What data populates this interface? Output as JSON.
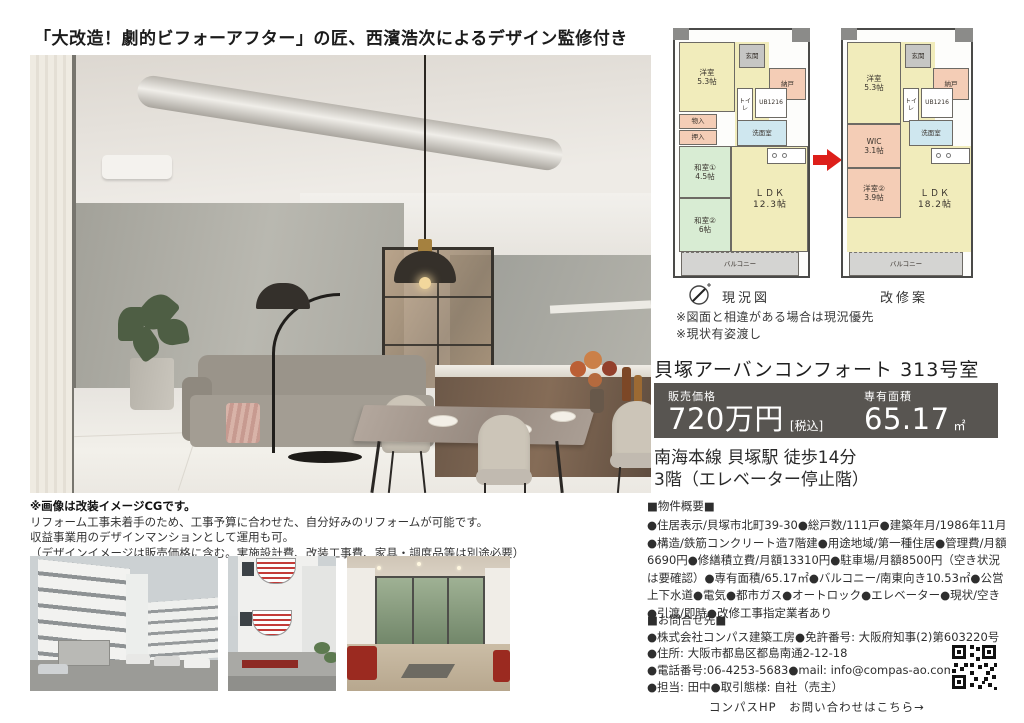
{
  "header": {
    "title": "「大改造！劇的ビフォーアフター」の匠、西濱浩次によるデザイン監修付き"
  },
  "floorplans": {
    "current": {
      "caption": "現況図",
      "rooms": {
        "yoshitsu": "洋室\n5.3帖",
        "genkan": "玄関",
        "nando": "納戸",
        "monoire": "物入",
        "oshiire": "押入",
        "washitsu1": "和室①\n4.5帖",
        "toilet": "トイレ",
        "ub": "UB1216",
        "senmen": "洗面室",
        "washitsu2": "和室②\n6帖",
        "ldk": "ＬＤＫ\n12.3帖",
        "balcony": "バルコニー"
      }
    },
    "renovated": {
      "caption": "改修案",
      "rooms": {
        "yoshitsu": "洋室\n5.3帖",
        "genkan": "玄関",
        "nando": "納戸",
        "wic": "WIC\n3.1帖",
        "toilet": "トイレ",
        "ub": "UB1216",
        "senmen": "洗面室",
        "yoshitsu2": "洋室②\n3.9帖",
        "ldk": "ＬＤＫ\n18.2帖",
        "balcony": "バルコニー"
      }
    },
    "notes": [
      "※図面と相違がある場合は現況優先",
      "※現状有姿渡し"
    ]
  },
  "property": {
    "name": "貝塚アーバンコンフォート 313号室",
    "price_label": "販売価格",
    "price": "720万円",
    "tax_note": "[税込]",
    "area_label": "専有面積",
    "area": "65.17",
    "area_unit": "㎡",
    "access": "南海本線 貝塚駅 徒歩14分",
    "floor": "3階（エレベーター停止階）"
  },
  "cg_note": {
    "title": "※画像は改装イメージCGです。",
    "lines": [
      "リフォーム工事未着手のため、工事予算に合わせた、自分好みのリフォームが可能です。",
      "収益事業用のデザインマンションとして運用も可。",
      "（デザインイメージは販売価格に含む。実施設計費、改装工事費、家具・調度品等は別途必要）"
    ]
  },
  "overview": {
    "heading": "■物件概要■",
    "body": "●住居表示/貝塚市北町39-30●総戸数/111戸●建築年月/1986年11月●構造/鉄筋コンクリート造7階建●用途地域/第一種住居●管理費/月額6690円●修繕積立費/月額13310円●駐車場/月額8500円（空き状況は要確認）●専有面積/65.17㎡●バルコニー/南東向き10.53㎡●公営上下水道●電気●都市ガス●オートロック●エレベーター●現状/空き●引渡/即時●改修工事指定業者あり"
  },
  "contact": {
    "heading": "■お問合せ先■",
    "lines": [
      "●株式会社コンパス建築工房●免許番号: 大阪府知事(2)第603220号",
      "●住所: 大阪市都島区都島南通2-12-18",
      "●電話番号:06-4253-5683●mail: info@compas-ao.com",
      "●担当: 田中●取引態様: 自社（売主）"
    ],
    "hp_line": "コンパスHP　お問い合わせはこちら→"
  },
  "colors": {
    "price_box_bg": "#585551",
    "arrow_red": "#dd1f1a",
    "plan_yellow": "#f1ecbb",
    "plan_green": "#d8ecd3",
    "plan_salmon": "#f4cdb6",
    "plan_blue": "#cfe7ef",
    "sign_red": "#8d2a24"
  }
}
